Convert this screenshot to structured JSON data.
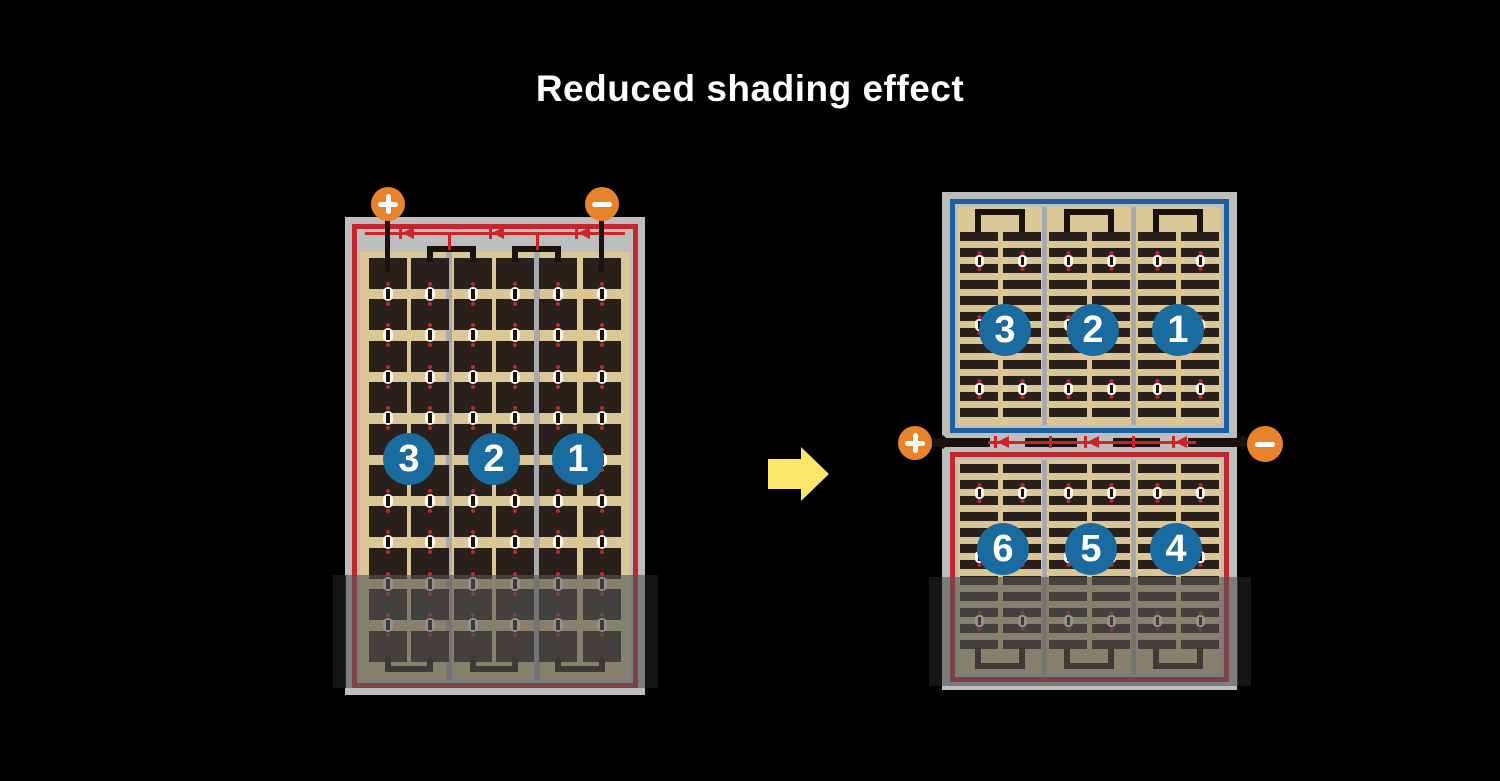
{
  "title": "Reduced shading effect",
  "colors": {
    "background": "#000000",
    "title_text": "#FFFFFF",
    "frame_gray": "#BDBDBD",
    "panel_tan": "#DBC795",
    "cell_dark": "#2A201B",
    "circuit_red": "#C1272D",
    "circuit_blue": "#1C5F9E",
    "badge_blue": "#1A6BA0",
    "terminal_orange": "#E8832B",
    "arrow_yellow": "#FAE66B",
    "wire_black": "#1A120D"
  },
  "left_module": {
    "terminals": {
      "positive": "+",
      "negative": "−"
    },
    "cell_grid": {
      "columns": 6,
      "rows": 10
    },
    "bypass_diodes": 3,
    "string_badges": [
      "3",
      "2",
      "1"
    ],
    "shaded": true
  },
  "right_module": {
    "terminals": {
      "positive": "+",
      "negative": "−"
    },
    "bypass_diodes": 3,
    "top_half": {
      "string_badges": [
        "3",
        "2",
        "1"
      ],
      "border_color": "#1C5F9E",
      "cell_grid": {
        "sections": 3,
        "bar_rows": 12
      }
    },
    "bottom_half": {
      "string_badges": [
        "6",
        "5",
        "4"
      ],
      "border_color": "#C1272D",
      "cell_grid": {
        "sections": 3,
        "bar_rows": 12
      }
    },
    "shaded": true
  }
}
